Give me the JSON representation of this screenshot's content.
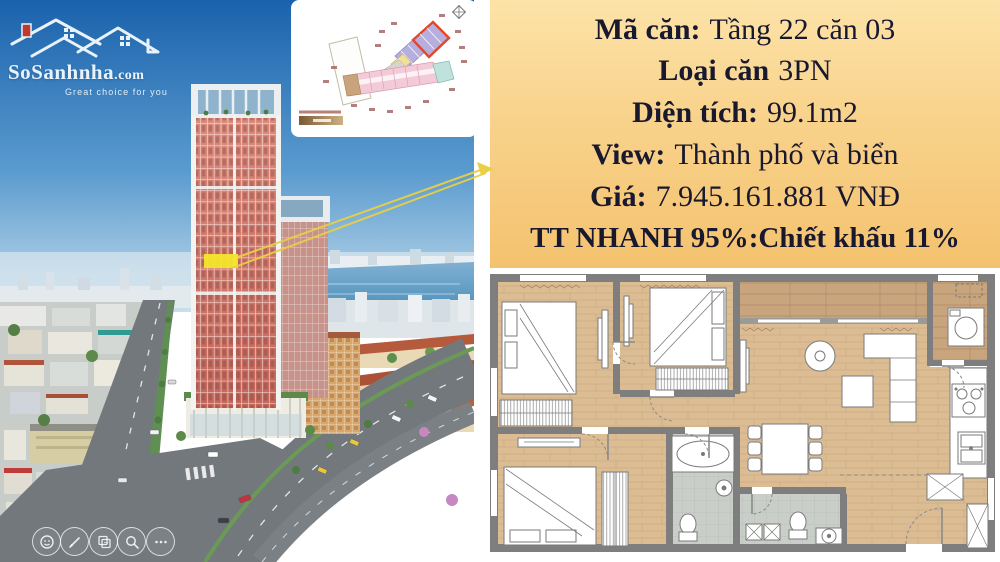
{
  "logo": {
    "brand": "SoSanhnha",
    "tld": ".com",
    "tagline": "Great choice for you"
  },
  "info_panel": {
    "bg_top": "#fde3a8",
    "bg_bottom": "#f4c26e",
    "text_color": "#18182f",
    "lines": [
      {
        "label": "Mã căn:",
        "value": "Tầng 22 căn 03"
      },
      {
        "label": "Loại căn",
        "value": "3PN"
      },
      {
        "label": "Diện tích:",
        "value": "99.1m2"
      },
      {
        "label": "View:",
        "value": "Thành phố và biển"
      },
      {
        "label": "Giá:",
        "value": "7.945.161.881 VNĐ"
      },
      {
        "label": "TT NHANH 95%:Chiết khấu 11%",
        "value": ""
      }
    ]
  },
  "photo": {
    "highlight_color": "#f4e62b",
    "arrow_color": "#e9cf45",
    "sky_top": "#1a62ac",
    "tower_color": "#cf7568"
  },
  "toolbar": {
    "icons": [
      "sticker-icon",
      "pen-icon",
      "copy-icon",
      "search-icon",
      "more-icon"
    ]
  },
  "mini_plan": {
    "highlight_outline": "#e3472b",
    "unit_colors": {
      "purple": "#b6aedd",
      "pink": "#f3cbd8",
      "teal": "#bfe2dc",
      "yellow": "#f0e09e"
    }
  },
  "floor_plan": {
    "wall_color": "#7e7e7e",
    "floor_color": "#dcbd93",
    "bath_color": "#c9cec9",
    "balcony_color": "#c9a57e"
  }
}
